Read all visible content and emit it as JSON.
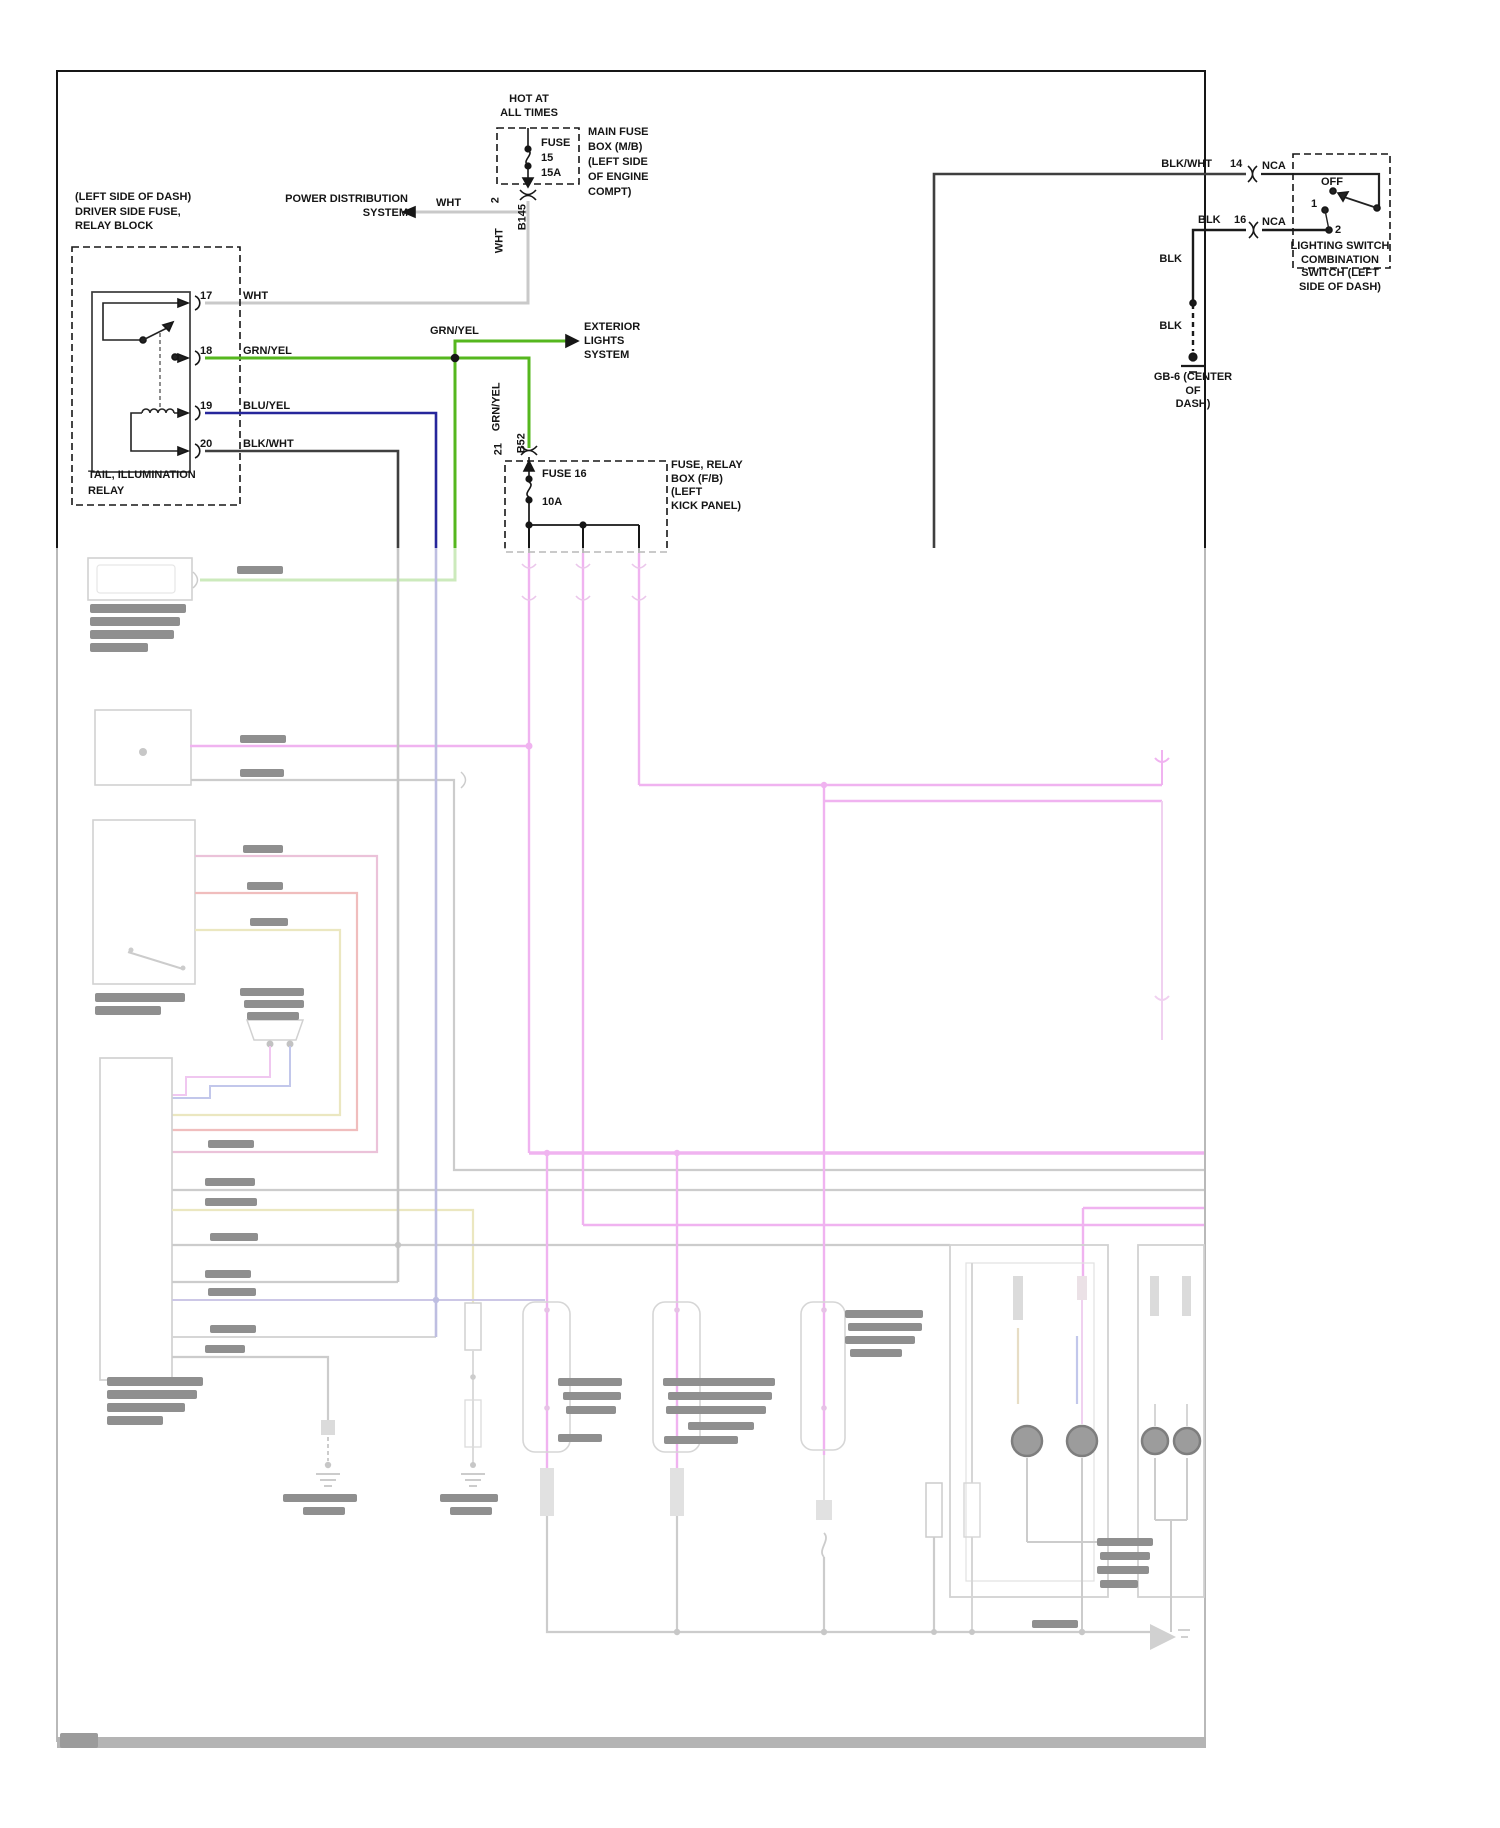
{
  "page": {
    "type": "automotive wiring diagram - tail / illumination lamps circuit",
    "colors": {
      "green_wire": "#55b71e",
      "blue_wire": "#26269b",
      "pink_wire": "#cc00cc",
      "white_wire": "#c9c9c9",
      "black_wire": "#1a1a1a"
    }
  },
  "fuse_main": {
    "hot_at": "HOT AT\nALL TIMES",
    "fuse": "FUSE\n15\n15A",
    "box": "MAIN FUSE\nBOX (M/B)\n(LEFT SIDE\nOF ENGINE\nCOMPT)",
    "pin": "2",
    "connector": "B145",
    "wire_down": "WHT",
    "wire_left": "WHT",
    "dest": "POWER DISTRIBUTION\nSYSTEM"
  },
  "relay": {
    "location": "(LEFT SIDE OF DASH)\nDRIVER SIDE FUSE,\nRELAY BLOCK",
    "name": "TAIL, ILLUMINATION\nRELAY",
    "pins": [
      {
        "num": "17",
        "wire": "WHT"
      },
      {
        "num": "18",
        "wire": "GRN/YEL"
      },
      {
        "num": "19",
        "wire": "BLU/YEL"
      },
      {
        "num": "20",
        "wire": "BLK/WHT"
      }
    ]
  },
  "exterior_branch": {
    "wire": "GRN/YEL",
    "dest": "EXTERIOR\nLIGHTS\nSYSTEM",
    "wire_down": "GRN/YEL",
    "pin": "21",
    "connector": "B52"
  },
  "fuse16": {
    "fuse": "FUSE 16",
    "rating": "10A",
    "box": "FUSE, RELAY\nBOX (F/B)\n(LEFT\nKICK PANEL)"
  },
  "switch": {
    "wire_in": "BLK/WHT",
    "pin_in": "14",
    "nca_in": "NCA",
    "wire_out": "BLK",
    "pin_out": "16",
    "nca_out": "NCA",
    "off": "OFF",
    "pos1": "1",
    "pos2": "2",
    "name": "LIGHTING SWITCH\nCOMBINATION\nSWITCH (LEFT\nSIDE OF DASH)",
    "gnd_wire_1": "BLK",
    "gnd_wire_2": "BLK",
    "ground": "GB-6 (CENTER\nOF\nDASH)"
  }
}
